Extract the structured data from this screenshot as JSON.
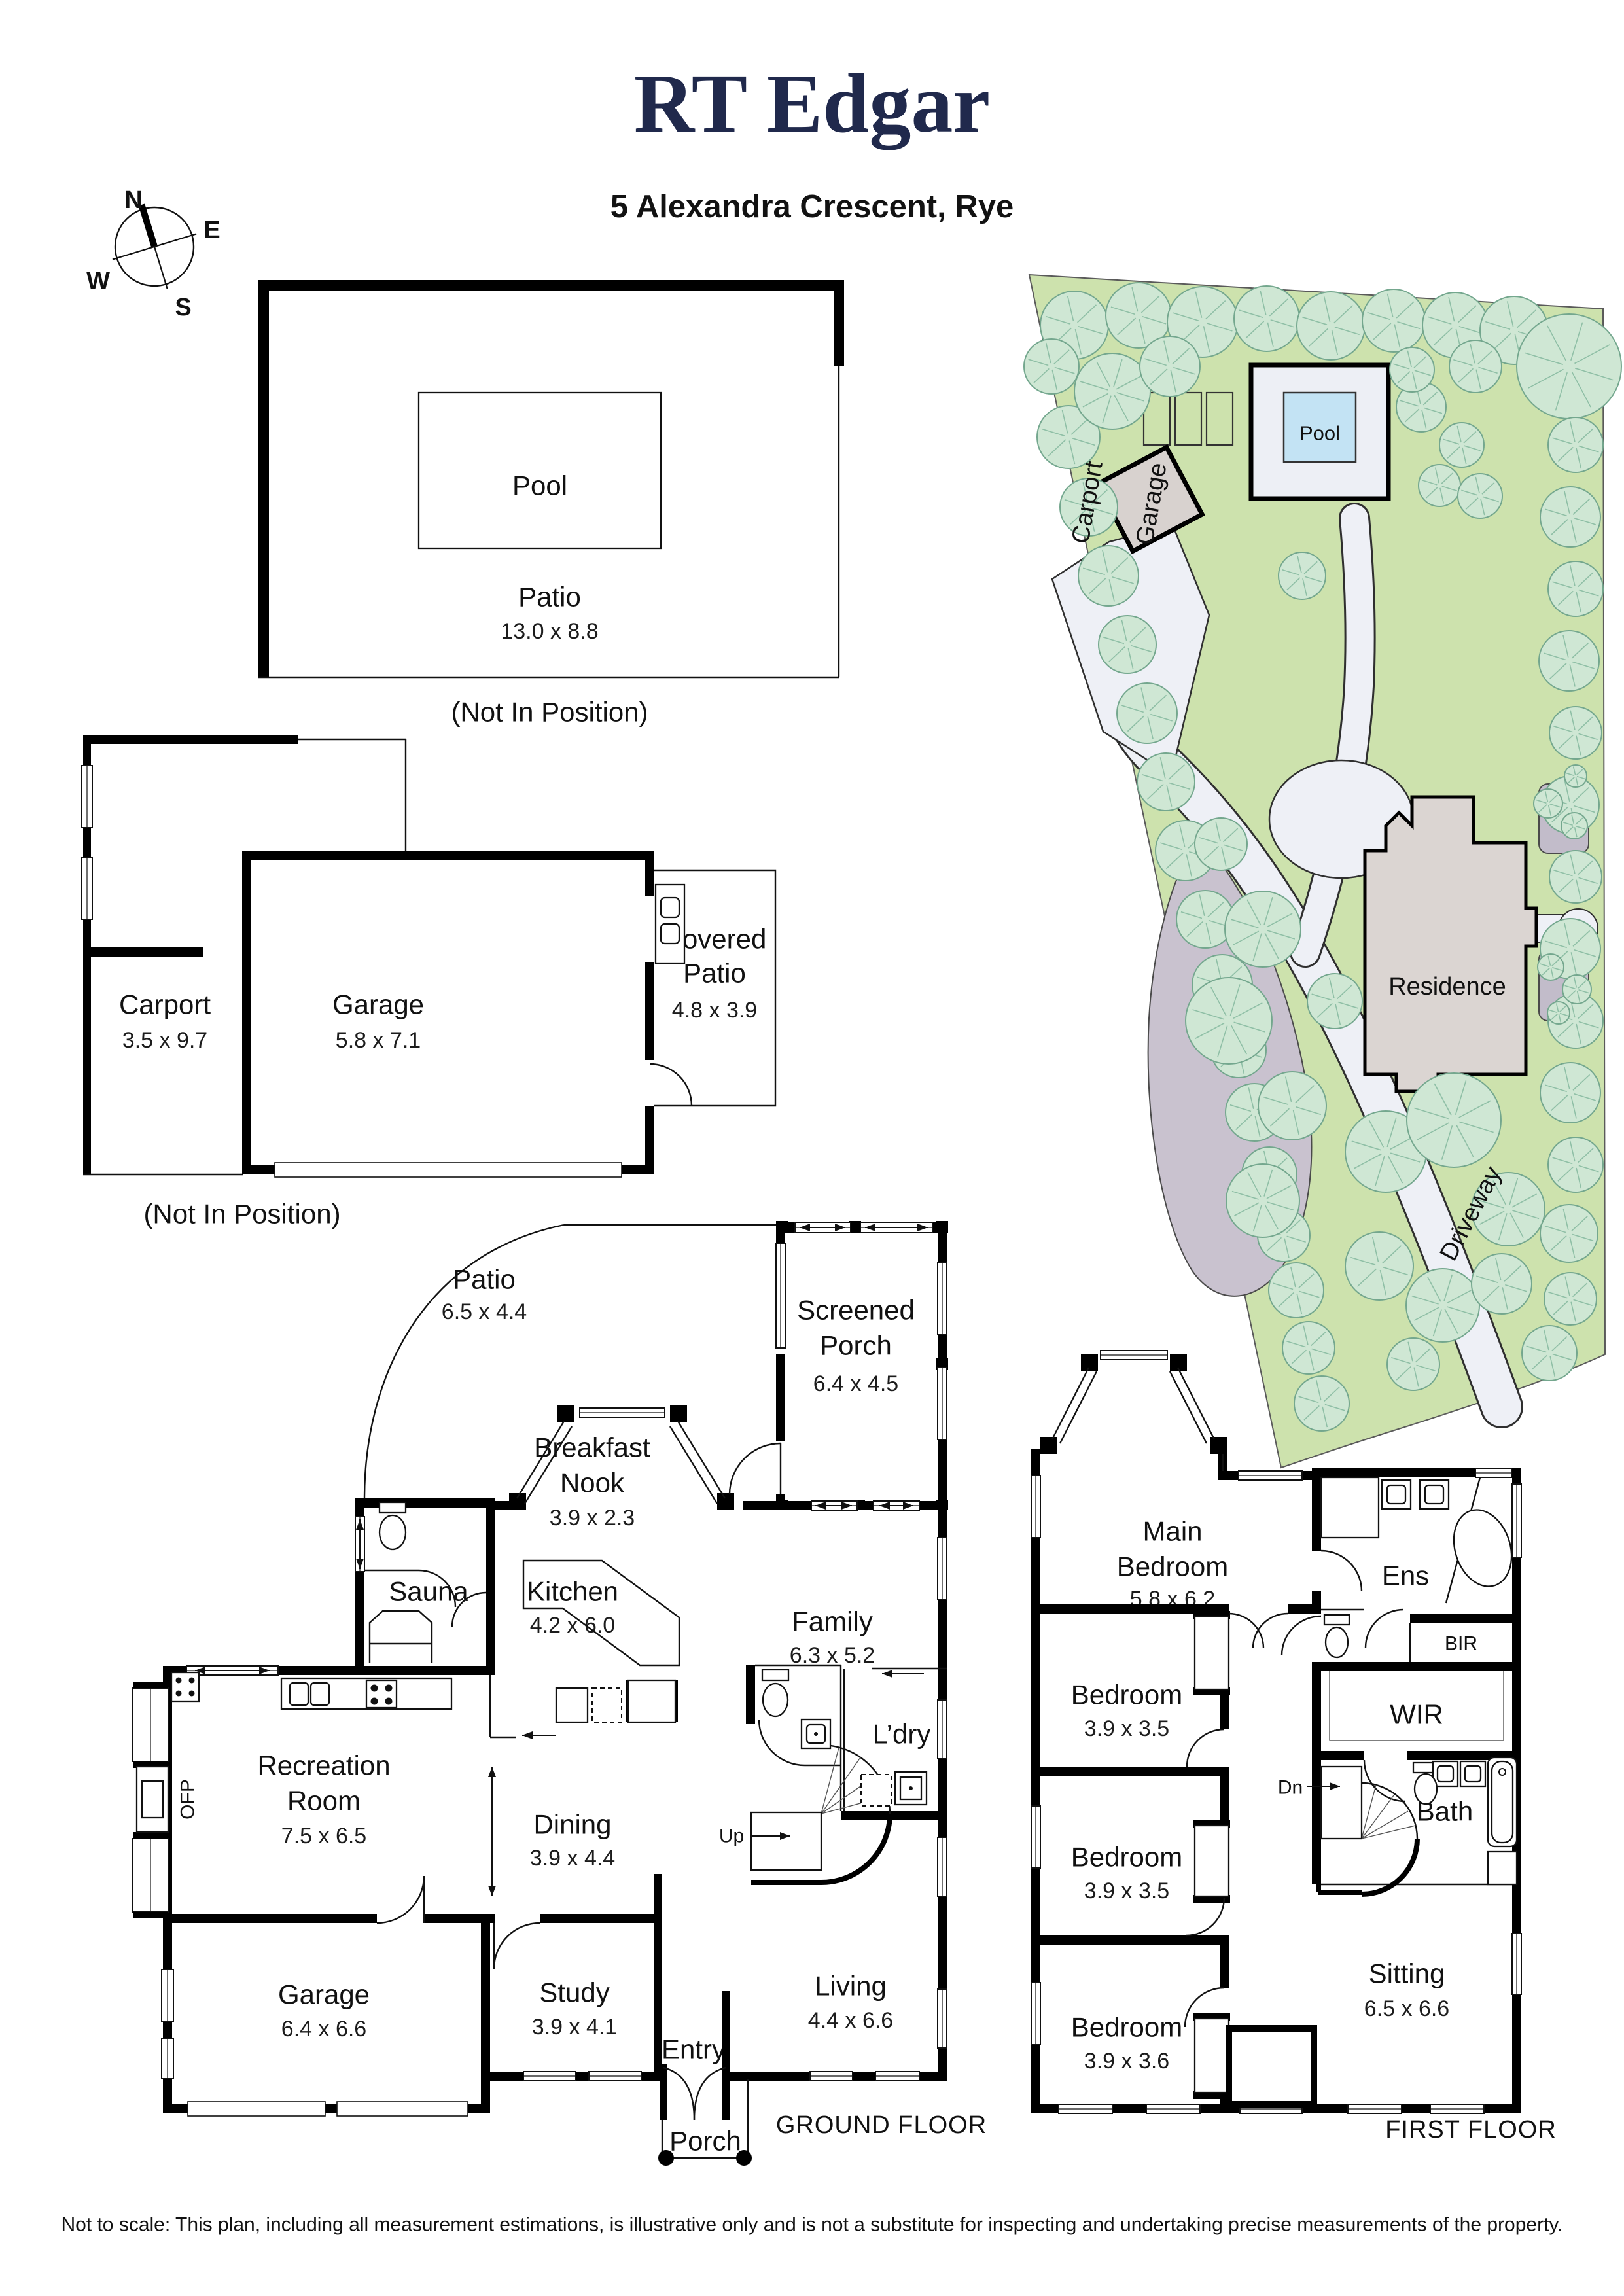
{
  "colors": {
    "brand_navy": "#20294c",
    "lot_green": "#cde2ad",
    "tree_fill": "#cfe7d4",
    "tree_stroke": "#74a78e",
    "pool_blue": "#c3e3f4",
    "path_grey": "#eef0f6",
    "gravel_grey": "#c9c2cf",
    "building_grey": "#dbd5d2",
    "bed_grey": "#c2bcca"
  },
  "header": {
    "brand": "RT Edgar",
    "address": "5 Alexandra Crescent, Rye"
  },
  "compass": {
    "n": "N",
    "e": "E",
    "s": "S",
    "w": "W"
  },
  "pool_plan": {
    "pool": "Pool",
    "room": "Patio",
    "dims": "13.0 x 8.8",
    "note": "(Not In Position)"
  },
  "site": {
    "pool": "Pool",
    "carport": "Carport",
    "garage": "Garage",
    "residence": "Residence",
    "driveway": "Driveway"
  },
  "outbuildings": {
    "carport": "Carport",
    "carport_dims": "3.5 x 9.7",
    "garage": "Garage",
    "garage_dims": "5.8 x 7.1",
    "covered_l1": "Covered",
    "covered_l2": "Patio",
    "covered_dims": "4.8 x 3.9",
    "note": "(Not In Position)"
  },
  "gf": {
    "title": "GROUND FLOOR",
    "patio": {
      "name": "Patio",
      "dims": "6.5 x 4.4"
    },
    "screened_porch": {
      "l1": "Screened",
      "l2": "Porch",
      "dims": "6.4 x 4.5"
    },
    "breakfast_nook": {
      "l1": "Breakfast",
      "l2": "Nook",
      "dims": "3.9 x 2.3"
    },
    "sauna": "Sauna",
    "kitchen": {
      "name": "Kitchen",
      "dims": "4.2 x 6.0"
    },
    "family": {
      "name": "Family",
      "dims": "6.3 x 5.2"
    },
    "laundry": "L’dry",
    "wm": "WM",
    "fridge": "F",
    "ofp": "OFP",
    "recreation": {
      "l1": "Recreation",
      "l2": "Room",
      "dims": "7.5 x 6.5"
    },
    "dining": {
      "name": "Dining",
      "dims": "3.9 x 4.4"
    },
    "up": "Up",
    "living": {
      "name": "Living",
      "dims": "4.4 x 6.6"
    },
    "garage": {
      "name": "Garage",
      "dims": "6.4 x 6.6"
    },
    "study": {
      "name": "Study",
      "dims": "3.9 x 4.1"
    },
    "entry": "Entry",
    "porch": "Porch"
  },
  "ff": {
    "title": "FIRST FLOOR",
    "main_bedroom": {
      "l1": "Main",
      "l2": "Bedroom",
      "dims": "5.8 x 6.2"
    },
    "ens": "Ens",
    "bir": "BIR",
    "wir": "WIR",
    "bath": "Bath",
    "dn": "Dn",
    "bedroom_a": {
      "name": "Bedroom",
      "dims": "3.9 x 3.5"
    },
    "bedroom_b": {
      "name": "Bedroom",
      "dims": "3.9 x 3.5"
    },
    "bedroom_c": {
      "name": "Bedroom",
      "dims": "3.9 x 3.6"
    },
    "sitting": {
      "name": "Sitting",
      "dims": "6.5 x 6.6"
    },
    "open_below": {
      "l1": "Open to",
      "l2": "Below"
    }
  },
  "disclaimer": "Not to scale: This plan, including all measurement estimations, is illustrative only and is not a substitute for inspecting and undertaking precise measurements of the property."
}
